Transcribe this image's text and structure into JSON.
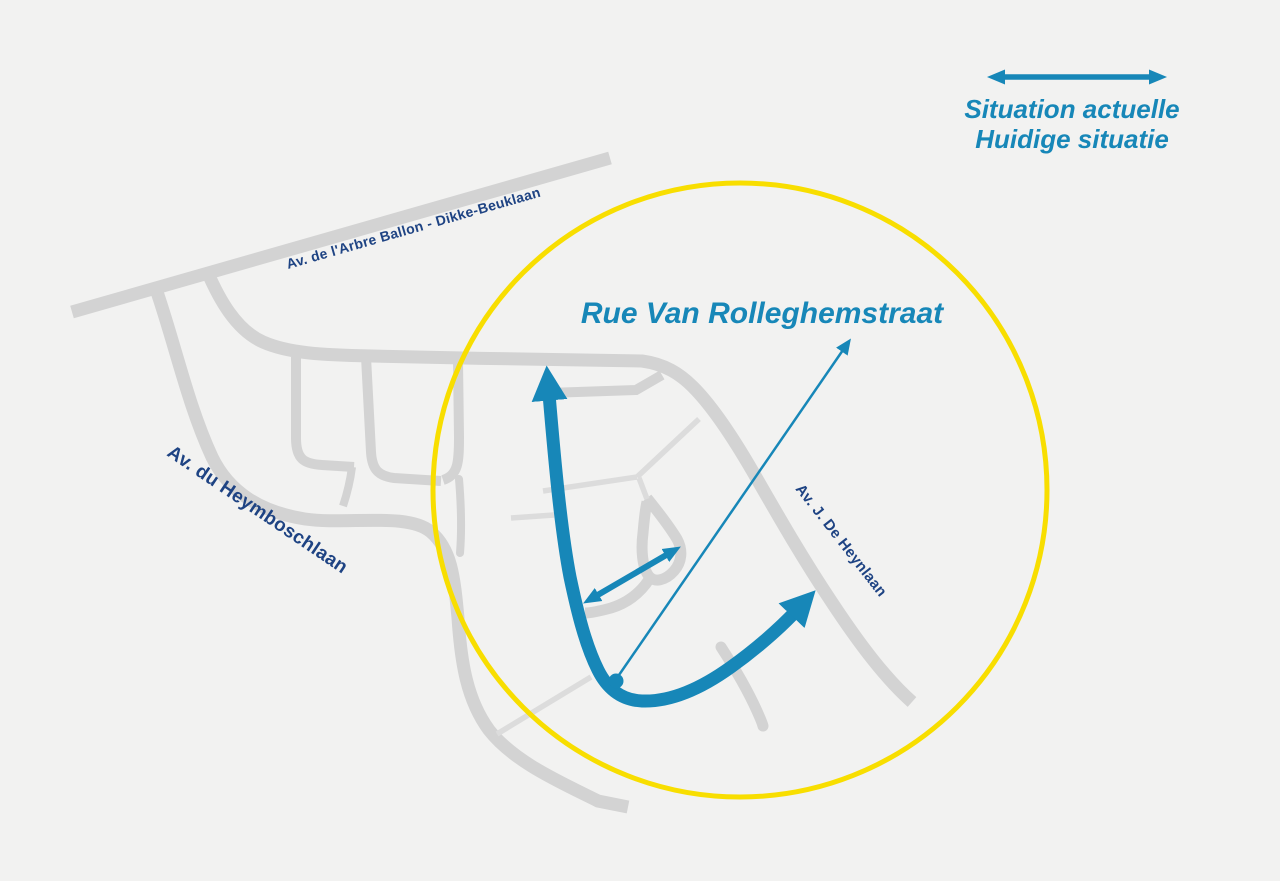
{
  "map": {
    "region_label": "Rue Van Rolleghemstraat",
    "street_labels": {
      "arbre_ballon": "Av. de l'Arbre Ballon - Dikke-Beuklaan",
      "heymboschlaan": "Av. du Heymboschlaan",
      "heynlaan": "Av. J. De Heynlaan"
    },
    "legend": {
      "line1_fr": "Situation actuelle",
      "line2_nl": "Huidige situatie"
    },
    "colors": {
      "arrow_blue": "#1787b8",
      "street_label_navy": "#1e4383",
      "road_gray": "#d3d3d3",
      "road_gray_thin": "#dcdcdc",
      "highlight_circle_yellow": "#f8de00",
      "background": "#f2f2f1"
    }
  }
}
